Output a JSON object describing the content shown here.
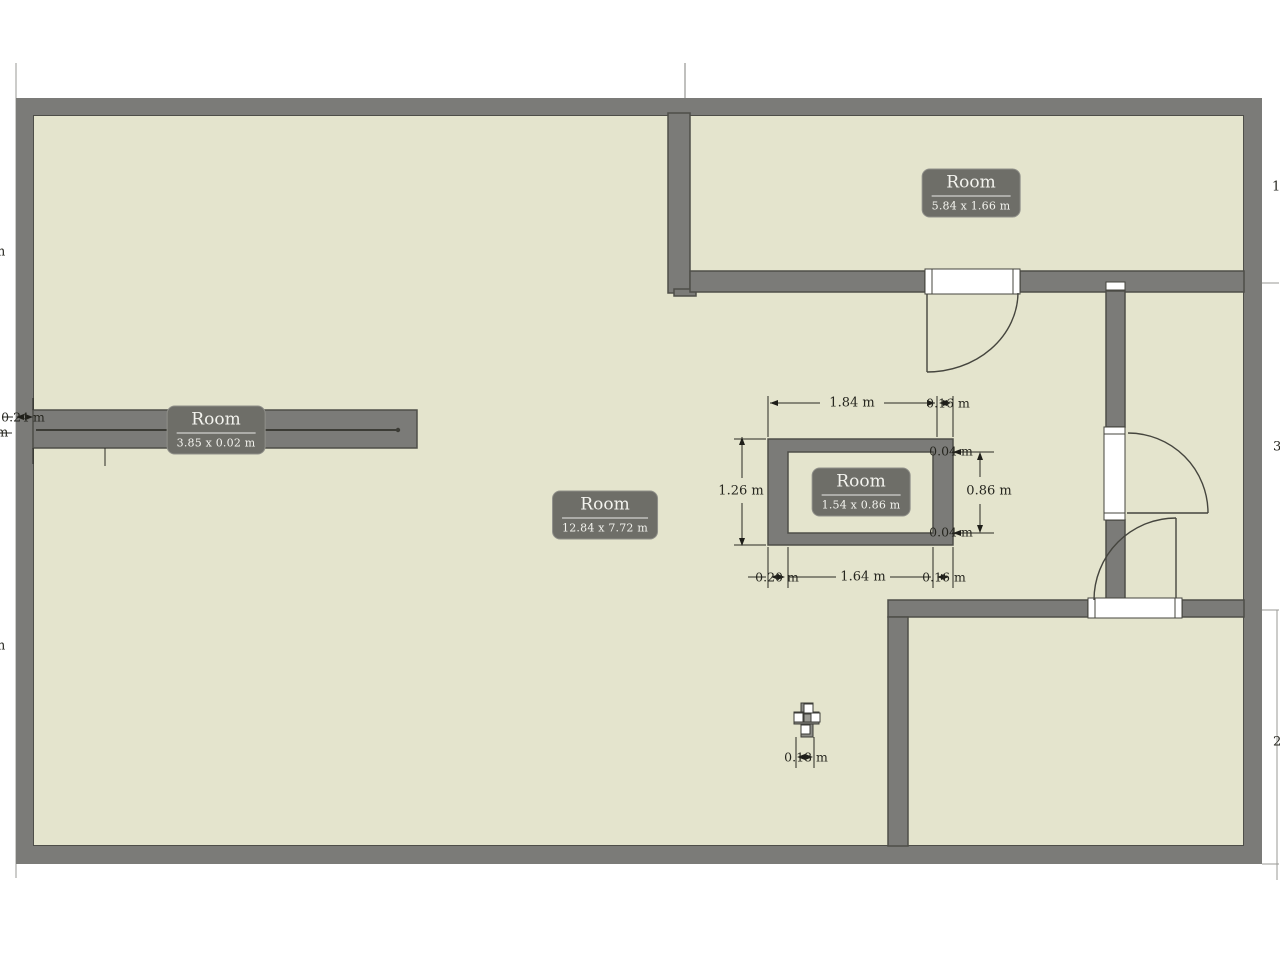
{
  "rooms": [
    {
      "name": "Room",
      "dims": "5.84 x 1.66 m"
    },
    {
      "name": "Room",
      "dims": "3.85 x 0.02 m"
    },
    {
      "name": "Room",
      "dims": "12.84 x 7.72 m"
    },
    {
      "name": "Room",
      "dims": "1.54 x 0.86 m"
    }
  ],
  "dims": {
    "inner_top": "1.84 m",
    "inner_top_right": "0.16 m",
    "inner_left": "1.26 m",
    "inner_right": "0.86 m",
    "inner_right_top": "0.04 m",
    "inner_right_bottom": "0.04 m",
    "inner_bottom_left": "0.20 m",
    "inner_bottom": "1.64 m",
    "inner_bottom_right": "0.16 m",
    "object_width": "0.18 m",
    "left_wall": "0.24 m",
    "edge_left_top": "m",
    "edge_left_mid": "m",
    "edge_left_bottom": "m",
    "edge_right_top": "1",
    "edge_right_mid": "3",
    "edge_right_bottom": "2"
  },
  "colors": {
    "wall": "#7b7b78",
    "wall_outline": "#4e4e49",
    "floor": "#e4e4cd",
    "label_bg": "#6e6e68",
    "dim_text": "#26261f"
  }
}
